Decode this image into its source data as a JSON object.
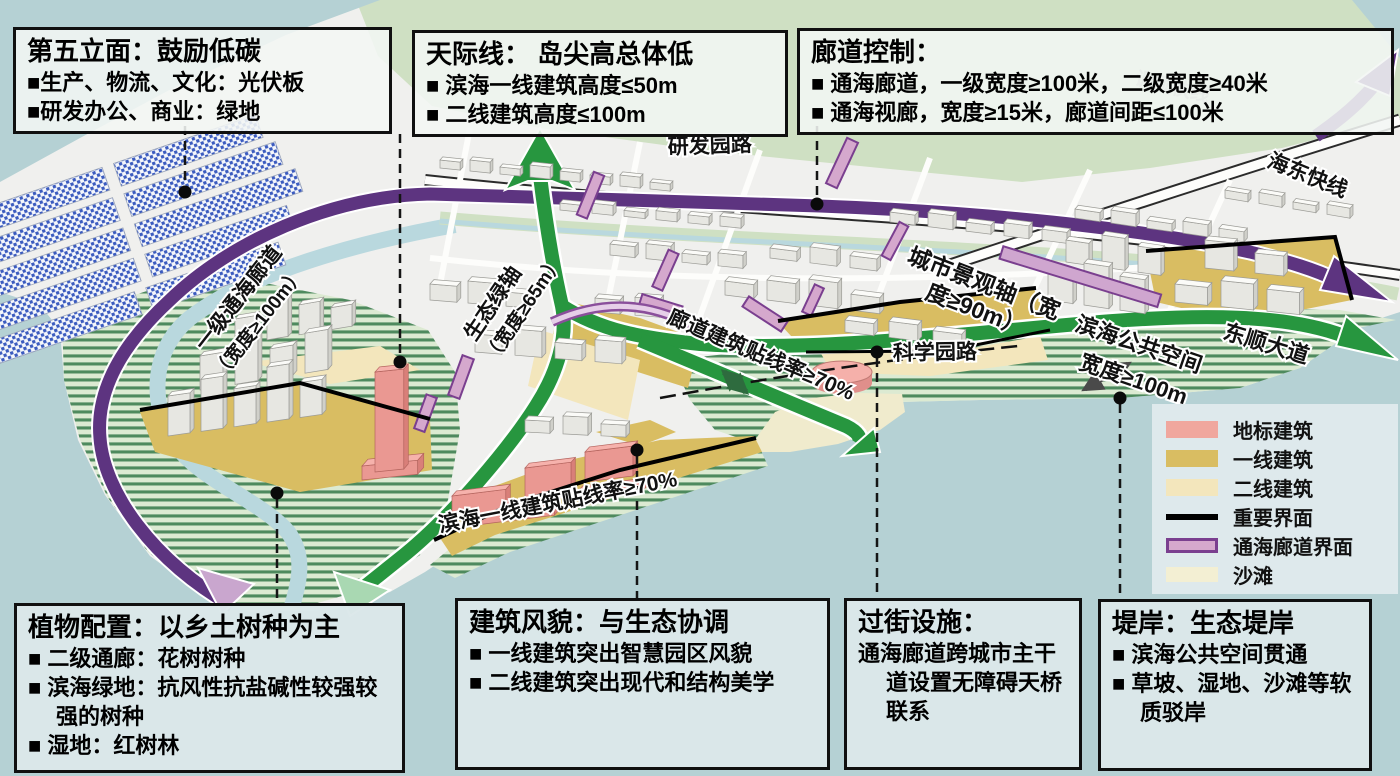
{
  "boxes": {
    "b1": {
      "title": "第五立面：鼓励低碳",
      "lines": [
        "■生产、物流、文化：光伏板",
        "■研发办公、商业：绿地"
      ]
    },
    "b2": {
      "title": "天际线： 岛尖高总体低",
      "lines": [
        "■ 滨海一线建筑高度≤50m",
        "■ 二线建筑高度≤100m"
      ]
    },
    "b3": {
      "title": "廊道控制：",
      "lines": [
        "■ 通海廊道，一级宽度≥100米，二级宽度≥40米",
        "■ 通海视廊，宽度≥15米，廊道间距≤100米"
      ]
    },
    "b4": {
      "title": "植物配置：以乡土树种为主",
      "lines": [
        "■ 二级通廊：花树树种",
        "■ 滨海绿地：抗风性抗盐碱性较强较强的树种",
        "■ 湿地：红树林"
      ]
    },
    "b5": {
      "title": "建筑风貌：与生态协调",
      "lines": [
        "■ 一线建筑突出智慧园区风貌",
        "■ 二线建筑突出现代和结构美学"
      ]
    },
    "b6": {
      "title": "过街设施：",
      "lines": [
        "通海廊道跨城市主干道设置无障碍天桥联系"
      ]
    },
    "b7": {
      "title": "堤岸：生态堤岸",
      "lines": [
        "■ 滨海公共空间贯通",
        "■ 草坡、湿地、沙滩等软质驳岸"
      ]
    }
  },
  "legend": {
    "items": [
      {
        "label": "地标建筑",
        "color": "#f0a79e"
      },
      {
        "label": "一线建筑",
        "color": "#d9bd62"
      },
      {
        "label": "二线建筑",
        "color": "#f3e6bc"
      },
      {
        "label": "重要界面",
        "color": "#000000"
      },
      {
        "label": "通海廊道界面",
        "color": "#d5a8cd",
        "border": "#7a3f8f"
      },
      {
        "label": "沙滩",
        "color": "#f3efd3"
      }
    ]
  },
  "map": {
    "labels": [
      {
        "text": "研发园路"
      },
      {
        "text": "调顺快线"
      },
      {
        "text": "海东快线"
      },
      {
        "text": "一级通海廊道"
      },
      {
        "text": "（宽度≥100m）"
      },
      {
        "text": "生态绿轴"
      },
      {
        "text": "（宽度≥65m）"
      },
      {
        "text": "廊道建筑贴线率≥70%"
      },
      {
        "text": "城市景观轴（宽"
      },
      {
        "text": "度≥90m）"
      },
      {
        "text": "滨海公共空间"
      },
      {
        "text": "宽度≥100m"
      },
      {
        "text": "东顺大道"
      },
      {
        "text": "科学园路"
      },
      {
        "text": "滨海一线建筑贴线率≥70%"
      }
    ],
    "colors": {
      "water": "#b5d1d4",
      "city": "#f0f0ee",
      "green_land": "#cfe0c3",
      "wetland_stripe": "#4e8a5e",
      "corridor_purple": "#5d3480",
      "eco_axis_green": "#27963f",
      "landmark_pink": "#f2a9a2",
      "frontline_tan": "#d9bd62",
      "secondline_tan": "#f3e6bc",
      "beach": "#f0ebcd",
      "pv_blue": "#3b5bbf",
      "important_interface": "#000000",
      "corridor_interface_fill": "#d5a8cd",
      "corridor_interface_border": "#7a3f8f"
    }
  }
}
